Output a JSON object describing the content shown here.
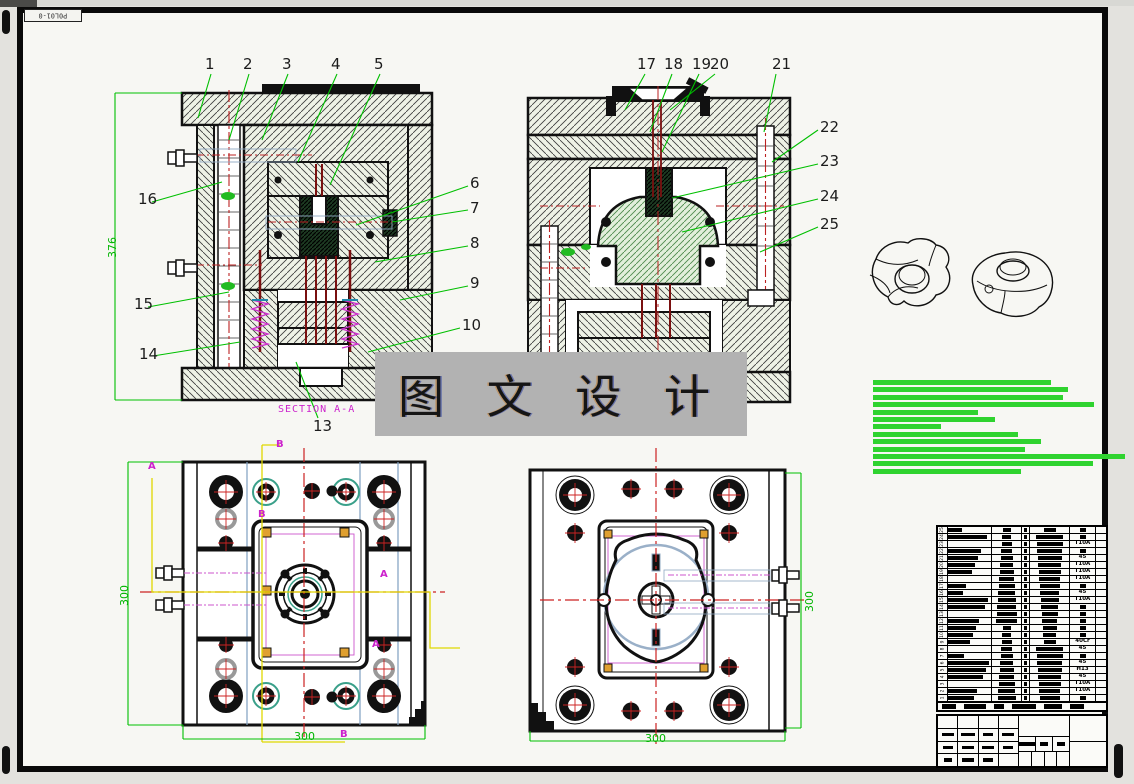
{
  "frame": {
    "doc_number": "P0L01-0"
  },
  "watermark": {
    "text": "图 文 设 计"
  },
  "views": {
    "section_label": "SECTION A-A",
    "letters": {
      "a": "A",
      "b": "B"
    }
  },
  "dimensions": {
    "section_height": "376",
    "plate_width": "300"
  },
  "callouts": [
    "1",
    "2",
    "3",
    "4",
    "5",
    "6",
    "7",
    "8",
    "9",
    "10",
    "13",
    "14",
    "15",
    "16",
    "17",
    "18",
    "19",
    "20",
    "21",
    "22",
    "23",
    "24",
    "25"
  ],
  "notes": {
    "bar_widths": [
      178,
      195,
      190,
      221,
      105,
      122,
      68,
      145,
      168,
      152,
      252,
      220,
      148
    ]
  },
  "bom": {
    "rows": [
      {
        "no": "25",
        "grade": ""
      },
      {
        "no": "24",
        "grade": ""
      },
      {
        "no": "23",
        "grade": "T10A"
      },
      {
        "no": "22",
        "grade": ""
      },
      {
        "no": "21",
        "grade": "45"
      },
      {
        "no": "20",
        "grade": "T10A"
      },
      {
        "no": "19",
        "grade": "T10A"
      },
      {
        "no": "18",
        "grade": "T10A"
      },
      {
        "no": "17",
        "grade": ""
      },
      {
        "no": "16",
        "grade": "45"
      },
      {
        "no": "15",
        "grade": "T10A"
      },
      {
        "no": "14",
        "grade": ""
      },
      {
        "no": "13",
        "grade": ""
      },
      {
        "no": "12",
        "grade": ""
      },
      {
        "no": "11",
        "grade": ""
      },
      {
        "no": "10",
        "grade": ""
      },
      {
        "no": "9",
        "grade": "40Cr"
      },
      {
        "no": "8",
        "grade": "45"
      },
      {
        "no": "7",
        "grade": ""
      },
      {
        "no": "6",
        "grade": "45"
      },
      {
        "no": "5",
        "grade": "H13"
      },
      {
        "no": "4",
        "grade": "45"
      },
      {
        "no": "3",
        "grade": "T10A"
      },
      {
        "no": "2",
        "grade": "T10A"
      },
      {
        "no": "1",
        "grade": ""
      }
    ]
  }
}
